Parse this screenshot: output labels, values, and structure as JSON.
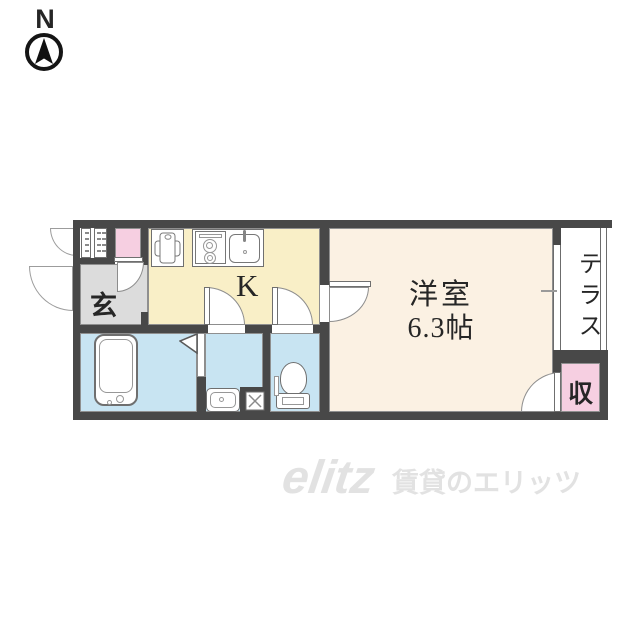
{
  "compass": {
    "label": "N"
  },
  "rooms": {
    "genkan": {
      "label": "玄",
      "color": "#dcdcdc"
    },
    "kitchen": {
      "label": "K",
      "color": "#f9efc7"
    },
    "western_room": {
      "label": "洋室",
      "size_label": "6.3帖",
      "color": "#fbf1e3"
    },
    "terrace": {
      "label": "テラス",
      "color": "#ffffff"
    },
    "storage": {
      "label": "収",
      "color": "#f6cfe1"
    },
    "laundry": {
      "color": "#f6cfe1"
    },
    "bathroom": {
      "color": "#c8e4f2"
    },
    "washroom": {
      "color": "#c8e4f2"
    },
    "toilet": {
      "color": "#c8e4f2"
    }
  },
  "palette": {
    "wall": "#484848",
    "outline": "#8f8f8f",
    "text": "#262626",
    "watermark": "#e2e2e2"
  },
  "fixtures": [
    "bathtub",
    "washbasin",
    "toilet",
    "stove",
    "kitchen-sink",
    "counter-unit",
    "washing-machine-pan",
    "floor-drain",
    "meter-box",
    "folding-door",
    "compass"
  ],
  "watermark": {
    "logo": "elitz",
    "text": "賃貸のエリッツ"
  }
}
